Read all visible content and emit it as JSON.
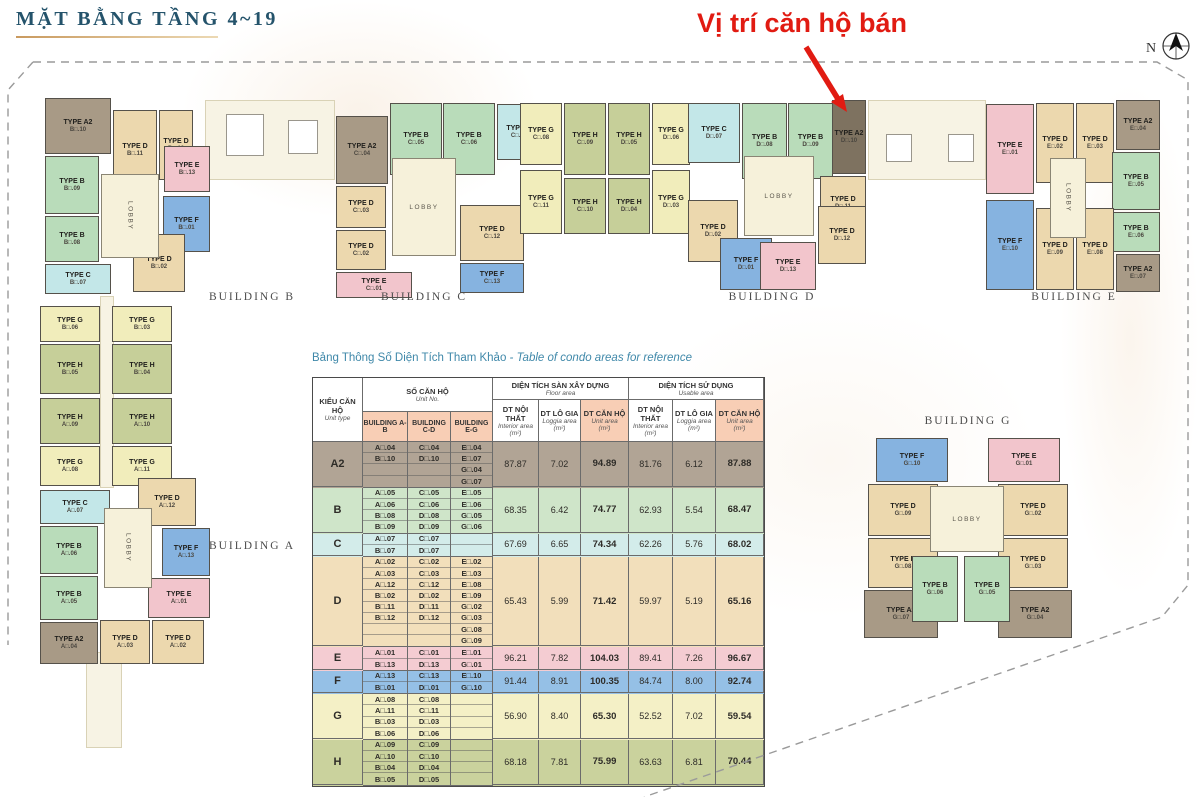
{
  "page_title": "MẶT BẰNG TẦNG 4~19",
  "annotation": {
    "sold_label": "Vị trí căn hộ bán"
  },
  "compass": {
    "label": "N"
  },
  "colors": {
    "accent_red": "#e11b12",
    "title_teal": "#24536b",
    "table_title_teal": "#3f88a9",
    "header_salmon": "#f8ceb5",
    "lobby": "#f6f1da",
    "corridor": "#f7f3e4",
    "sold_unit": "#7e7260",
    "types": {
      "A2": "#a89a86",
      "B": "#b9dcba",
      "C": "#c3e7e8",
      "D": "#ecd8ae",
      "E": "#f2c5cc",
      "F": "#86b3e0",
      "G": "#f1edbb",
      "H": "#c6cf99"
    },
    "row_types": {
      "A2": "#b1a495",
      "B": "#cfe5c9",
      "C": "#d3ecea",
      "D": "#f2dfbb",
      "E": "#f4ccd2",
      "F": "#95c0e6",
      "G": "#f4f0c6",
      "H": "#cad29d"
    }
  },
  "plan": {
    "lobby_label": "LOBBY",
    "building_labels": [
      {
        "text": "BUILDING B",
        "x": 252,
        "y": 291
      },
      {
        "text": "BUILDING C",
        "x": 424,
        "y": 291
      },
      {
        "text": "BUILDING D",
        "x": 772,
        "y": 291
      },
      {
        "text": "BUILDING E",
        "x": 1074,
        "y": 291
      },
      {
        "text": "BUILDING A",
        "x": 252,
        "y": 540
      },
      {
        "text": "BUILDING G",
        "x": 968,
        "y": 415
      }
    ],
    "units": [
      {
        "t": "A2",
        "no": "B□.10",
        "x": 45,
        "y": 98,
        "w": 66,
        "h": 56
      },
      {
        "t": "D",
        "no": "B□.11",
        "x": 113,
        "y": 110,
        "w": 44,
        "h": 80
      },
      {
        "t": "D",
        "no": "B□.12",
        "x": 159,
        "y": 110,
        "w": 34,
        "h": 70
      },
      {
        "t": "E",
        "no": "B□.13",
        "x": 164,
        "y": 146,
        "w": 46,
        "h": 46
      },
      {
        "t": "B",
        "no": "B□.09",
        "x": 45,
        "y": 156,
        "w": 54,
        "h": 58
      },
      {
        "t": "B",
        "no": "B□.08",
        "x": 45,
        "y": 216,
        "w": 54,
        "h": 46
      },
      {
        "t": "C",
        "no": "B□.07",
        "x": 45,
        "y": 264,
        "w": 66,
        "h": 30
      },
      {
        "t": "F",
        "no": "B□.01",
        "x": 163,
        "y": 196,
        "w": 47,
        "h": 56
      },
      {
        "t": "D",
        "no": "B□.02",
        "x": 133,
        "y": 234,
        "w": 52,
        "h": 58
      },
      {
        "t": "A2",
        "no": "C□.04",
        "x": 336,
        "y": 116,
        "w": 52,
        "h": 68
      },
      {
        "t": "B",
        "no": "C□.05",
        "x": 390,
        "y": 103,
        "w": 52,
        "h": 72
      },
      {
        "t": "B",
        "no": "C□.06",
        "x": 443,
        "y": 103,
        "w": 52,
        "h": 72
      },
      {
        "t": "C",
        "no": "C□.07",
        "x": 497,
        "y": 104,
        "w": 44,
        "h": 56
      },
      {
        "t": "D",
        "no": "C□.03",
        "x": 336,
        "y": 186,
        "w": 50,
        "h": 42
      },
      {
        "t": "D",
        "no": "C□.02",
        "x": 336,
        "y": 230,
        "w": 50,
        "h": 40
      },
      {
        "t": "E",
        "no": "C□.01",
        "x": 336,
        "y": 272,
        "w": 76,
        "h": 26
      },
      {
        "t": "D",
        "no": "C□.12",
        "x": 460,
        "y": 205,
        "w": 64,
        "h": 56
      },
      {
        "t": "F",
        "no": "C□.13",
        "x": 460,
        "y": 263,
        "w": 64,
        "h": 30
      },
      {
        "t": "G",
        "no": "C□.08",
        "x": 520,
        "y": 103,
        "w": 42,
        "h": 62
      },
      {
        "t": "H",
        "no": "C□.09",
        "x": 564,
        "y": 103,
        "w": 42,
        "h": 72
      },
      {
        "t": "H",
        "no": "D□.05",
        "x": 608,
        "y": 103,
        "w": 42,
        "h": 72
      },
      {
        "t": "G",
        "no": "D□.06",
        "x": 652,
        "y": 103,
        "w": 38,
        "h": 62
      },
      {
        "t": "G",
        "no": "C□.11",
        "x": 520,
        "y": 170,
        "w": 42,
        "h": 64
      },
      {
        "t": "H",
        "no": "C□.10",
        "x": 564,
        "y": 178,
        "w": 42,
        "h": 56
      },
      {
        "t": "H",
        "no": "D□.04",
        "x": 608,
        "y": 178,
        "w": 42,
        "h": 56
      },
      {
        "t": "G",
        "no": "D□.03",
        "x": 652,
        "y": 170,
        "w": 38,
        "h": 64
      },
      {
        "t": "C",
        "no": "D□.07",
        "x": 688,
        "y": 103,
        "w": 52,
        "h": 60
      },
      {
        "t": "B",
        "no": "D□.08",
        "x": 742,
        "y": 103,
        "w": 45,
        "h": 76
      },
      {
        "t": "B",
        "no": "D□.09",
        "x": 788,
        "y": 103,
        "w": 45,
        "h": 76
      },
      {
        "t": "A2",
        "no": "D□.10",
        "x": 832,
        "y": 100,
        "w": 34,
        "h": 74,
        "sold": true
      },
      {
        "t": "D",
        "no": "D□.11",
        "x": 820,
        "y": 176,
        "w": 46,
        "h": 54
      },
      {
        "t": "D",
        "no": "D□.02",
        "x": 688,
        "y": 200,
        "w": 50,
        "h": 62
      },
      {
        "t": "F",
        "no": "D□.01",
        "x": 720,
        "y": 238,
        "w": 52,
        "h": 52
      },
      {
        "t": "D",
        "no": "D□.12",
        "x": 818,
        "y": 206,
        "w": 48,
        "h": 58
      },
      {
        "t": "E",
        "no": "D□.13",
        "x": 760,
        "y": 242,
        "w": 56,
        "h": 48
      },
      {
        "t": "E",
        "no": "E□.01",
        "x": 986,
        "y": 104,
        "w": 48,
        "h": 90
      },
      {
        "t": "D",
        "no": "E□.02",
        "x": 1036,
        "y": 103,
        "w": 38,
        "h": 80
      },
      {
        "t": "D",
        "no": "E□.03",
        "x": 1076,
        "y": 103,
        "w": 38,
        "h": 80
      },
      {
        "t": "A2",
        "no": "E□.04",
        "x": 1116,
        "y": 100,
        "w": 44,
        "h": 50
      },
      {
        "t": "B",
        "no": "E□.05",
        "x": 1112,
        "y": 152,
        "w": 48,
        "h": 58
      },
      {
        "t": "B",
        "no": "E□.06",
        "x": 1112,
        "y": 212,
        "w": 48,
        "h": 40
      },
      {
        "t": "A2",
        "no": "E□.07",
        "x": 1116,
        "y": 254,
        "w": 44,
        "h": 38
      },
      {
        "t": "F",
        "no": "E□.10",
        "x": 986,
        "y": 200,
        "w": 48,
        "h": 90
      },
      {
        "t": "D",
        "no": "E□.09",
        "x": 1036,
        "y": 208,
        "w": 38,
        "h": 82
      },
      {
        "t": "D",
        "no": "E□.08",
        "x": 1076,
        "y": 208,
        "w": 38,
        "h": 82
      },
      {
        "t": "G",
        "no": "B□.06",
        "x": 40,
        "y": 306,
        "w": 60,
        "h": 36
      },
      {
        "t": "G",
        "no": "B□.03",
        "x": 112,
        "y": 306,
        "w": 60,
        "h": 36
      },
      {
        "t": "H",
        "no": "B□.05",
        "x": 40,
        "y": 344,
        "w": 60,
        "h": 50
      },
      {
        "t": "H",
        "no": "B□.04",
        "x": 112,
        "y": 344,
        "w": 60,
        "h": 50
      },
      {
        "t": "H",
        "no": "A□.09",
        "x": 40,
        "y": 398,
        "w": 60,
        "h": 46
      },
      {
        "t": "H",
        "no": "A□.10",
        "x": 112,
        "y": 398,
        "w": 60,
        "h": 46
      },
      {
        "t": "G",
        "no": "A□.08",
        "x": 40,
        "y": 446,
        "w": 60,
        "h": 40
      },
      {
        "t": "G",
        "no": "A□.11",
        "x": 112,
        "y": 446,
        "w": 60,
        "h": 40
      },
      {
        "t": "C",
        "no": "A□.07",
        "x": 40,
        "y": 490,
        "w": 70,
        "h": 34
      },
      {
        "t": "B",
        "no": "A□.06",
        "x": 40,
        "y": 526,
        "w": 58,
        "h": 48
      },
      {
        "t": "B",
        "no": "A□.05",
        "x": 40,
        "y": 576,
        "w": 58,
        "h": 44
      },
      {
        "t": "A2",
        "no": "A□.04",
        "x": 40,
        "y": 622,
        "w": 58,
        "h": 42
      },
      {
        "t": "D",
        "no": "A□.12",
        "x": 138,
        "y": 478,
        "w": 58,
        "h": 48
      },
      {
        "t": "F",
        "no": "A□.13",
        "x": 162,
        "y": 528,
        "w": 48,
        "h": 48
      },
      {
        "t": "E",
        "no": "A□.01",
        "x": 148,
        "y": 578,
        "w": 62,
        "h": 40
      },
      {
        "t": "D",
        "no": "A□.03",
        "x": 100,
        "y": 620,
        "w": 50,
        "h": 44
      },
      {
        "t": "D",
        "no": "A□.02",
        "x": 152,
        "y": 620,
        "w": 52,
        "h": 44
      },
      {
        "t": "F",
        "no": "G□.10",
        "x": 876,
        "y": 438,
        "w": 72,
        "h": 44
      },
      {
        "t": "E",
        "no": "G□.01",
        "x": 988,
        "y": 438,
        "w": 72,
        "h": 44
      },
      {
        "t": "D",
        "no": "G□.09",
        "x": 868,
        "y": 484,
        "w": 70,
        "h": 52
      },
      {
        "t": "D",
        "no": "G□.02",
        "x": 998,
        "y": 484,
        "w": 70,
        "h": 52
      },
      {
        "t": "D",
        "no": "G□.08",
        "x": 868,
        "y": 538,
        "w": 70,
        "h": 50
      },
      {
        "t": "D",
        "no": "G□.03",
        "x": 998,
        "y": 538,
        "w": 70,
        "h": 50
      },
      {
        "t": "A2",
        "no": "G□.07",
        "x": 864,
        "y": 590,
        "w": 74,
        "h": 48
      },
      {
        "t": "A2",
        "no": "G□.04",
        "x": 998,
        "y": 590,
        "w": 74,
        "h": 48
      },
      {
        "t": "B",
        "no": "G□.06",
        "x": 912,
        "y": 556,
        "w": 46,
        "h": 66
      },
      {
        "t": "B",
        "no": "G□.05",
        "x": 964,
        "y": 556,
        "w": 46,
        "h": 66
      }
    ],
    "lobbies": [
      {
        "x": 101,
        "y": 174,
        "w": 58,
        "h": 84,
        "vertical": true
      },
      {
        "x": 392,
        "y": 158,
        "w": 64,
        "h": 98,
        "vertical": false
      },
      {
        "x": 744,
        "y": 156,
        "w": 70,
        "h": 80,
        "vertical": false
      },
      {
        "x": 1050,
        "y": 158,
        "w": 36,
        "h": 80,
        "vertical": true
      },
      {
        "x": 104,
        "y": 508,
        "w": 48,
        "h": 80,
        "vertical": true
      },
      {
        "x": 930,
        "y": 486,
        "w": 74,
        "h": 66,
        "vertical": false
      }
    ],
    "corridors": [
      {
        "x": 205,
        "y": 100,
        "w": 130,
        "h": 80
      },
      {
        "x": 868,
        "y": 100,
        "w": 118,
        "h": 80
      },
      {
        "x": 100,
        "y": 296,
        "w": 14,
        "h": 192
      },
      {
        "x": 86,
        "y": 652,
        "w": 36,
        "h": 96
      }
    ],
    "core_squares": [
      {
        "x": 226,
        "y": 114,
        "w": 38,
        "h": 42
      },
      {
        "x": 288,
        "y": 120,
        "w": 30,
        "h": 34
      },
      {
        "x": 886,
        "y": 134,
        "w": 26,
        "h": 28
      },
      {
        "x": 948,
        "y": 134,
        "w": 26,
        "h": 28
      }
    ]
  },
  "table": {
    "title_vn": "Bảng Thông Số Diện Tích Tham Khảo",
    "title_en": " - Table of condo areas for reference",
    "header": {
      "unit_type_vn": "KIỂU CĂN HỘ",
      "unit_type_en": "Unit type",
      "unit_no_vn": "SỐ CĂN HỘ",
      "unit_no_en": "Unit No.",
      "buildings": [
        "BUILDING A-B",
        "BUILDING C-D",
        "BUILDING E-G"
      ],
      "floor_group_vn": "DIỆN TÍCH SÀN XÂY DỰNG",
      "floor_group_en": "Floor area",
      "usable_group_vn": "DIỆN TÍCH SỬ DỤNG",
      "usable_group_en": "Usable area",
      "area_cols": [
        {
          "vn": "DT NỘI THẤT",
          "en": "Interior area",
          "unit": "(m²)",
          "highlight": false
        },
        {
          "vn": "DT LÔ GIA",
          "en": "Loggia area",
          "unit": "(m²)",
          "highlight": false
        },
        {
          "vn": "DT CĂN HỘ",
          "en": "Unit area",
          "unit": "(m²)",
          "highlight": true
        }
      ]
    },
    "rows": [
      {
        "type": "A2",
        "ab": [
          "A□.04",
          "B□.10",
          "",
          ""
        ],
        "cd": [
          "C□.04",
          "D□.10",
          "",
          ""
        ],
        "eg": [
          "E□.04",
          "E□.07",
          "G□.04",
          "G□.07"
        ],
        "vals": [
          "87.87",
          "7.02",
          "94.89",
          "81.76",
          "6.12",
          "87.88"
        ]
      },
      {
        "type": "B",
        "ab": [
          "A□.05",
          "A□.06",
          "B□.08",
          "B□.09"
        ],
        "cd": [
          "C□.05",
          "C□.06",
          "D□.08",
          "D□.09"
        ],
        "eg": [
          "E□.05",
          "E□.06",
          "G□.05",
          "G□.06"
        ],
        "vals": [
          "68.35",
          "6.42",
          "74.77",
          "62.93",
          "5.54",
          "68.47"
        ]
      },
      {
        "type": "C",
        "ab": [
          "A□.07",
          "B□.07"
        ],
        "cd": [
          "C□.07",
          "D□.07"
        ],
        "eg": [
          "",
          ""
        ],
        "vals": [
          "67.69",
          "6.65",
          "74.34",
          "62.26",
          "5.76",
          "68.02"
        ]
      },
      {
        "type": "D",
        "ab": [
          "A□.02",
          "A□.03",
          "A□.12",
          "B□.02",
          "B□.11",
          "B□.12",
          "",
          ""
        ],
        "cd": [
          "C□.02",
          "C□.03",
          "C□.12",
          "D□.02",
          "D□.11",
          "D□.12",
          "",
          ""
        ],
        "eg": [
          "E□.02",
          "E□.03",
          "E□.08",
          "E□.09",
          "G□.02",
          "G□.03",
          "G□.08",
          "G□.09"
        ],
        "vals": [
          "65.43",
          "5.99",
          "71.42",
          "59.97",
          "5.19",
          "65.16"
        ]
      },
      {
        "type": "E",
        "ab": [
          "A□.01",
          "B□.13"
        ],
        "cd": [
          "C□.01",
          "D□.13"
        ],
        "eg": [
          "E□.01",
          "G□.01"
        ],
        "vals": [
          "96.21",
          "7.82",
          "104.03",
          "89.41",
          "7.26",
          "96.67"
        ]
      },
      {
        "type": "F",
        "ab": [
          "A□.13",
          "B□.01"
        ],
        "cd": [
          "C□.13",
          "D□.01"
        ],
        "eg": [
          "E□.10",
          "G□.10"
        ],
        "vals": [
          "91.44",
          "8.91",
          "100.35",
          "84.74",
          "8.00",
          "92.74"
        ]
      },
      {
        "type": "G",
        "ab": [
          "A□.08",
          "A□.11",
          "B□.03",
          "B□.06"
        ],
        "cd": [
          "C□.08",
          "C□.11",
          "D□.03",
          "D□.06"
        ],
        "eg": [
          "",
          "",
          "",
          ""
        ],
        "vals": [
          "56.90",
          "8.40",
          "65.30",
          "52.52",
          "7.02",
          "59.54"
        ]
      },
      {
        "type": "H",
        "ab": [
          "A□.09",
          "A□.10",
          "B□.04",
          "B□.05"
        ],
        "cd": [
          "C□.09",
          "C□.10",
          "D□.04",
          "D□.05"
        ],
        "eg": [
          "",
          "",
          "",
          ""
        ],
        "vals": [
          "68.18",
          "7.81",
          "75.99",
          "63.63",
          "6.81",
          "70.44"
        ]
      }
    ]
  }
}
